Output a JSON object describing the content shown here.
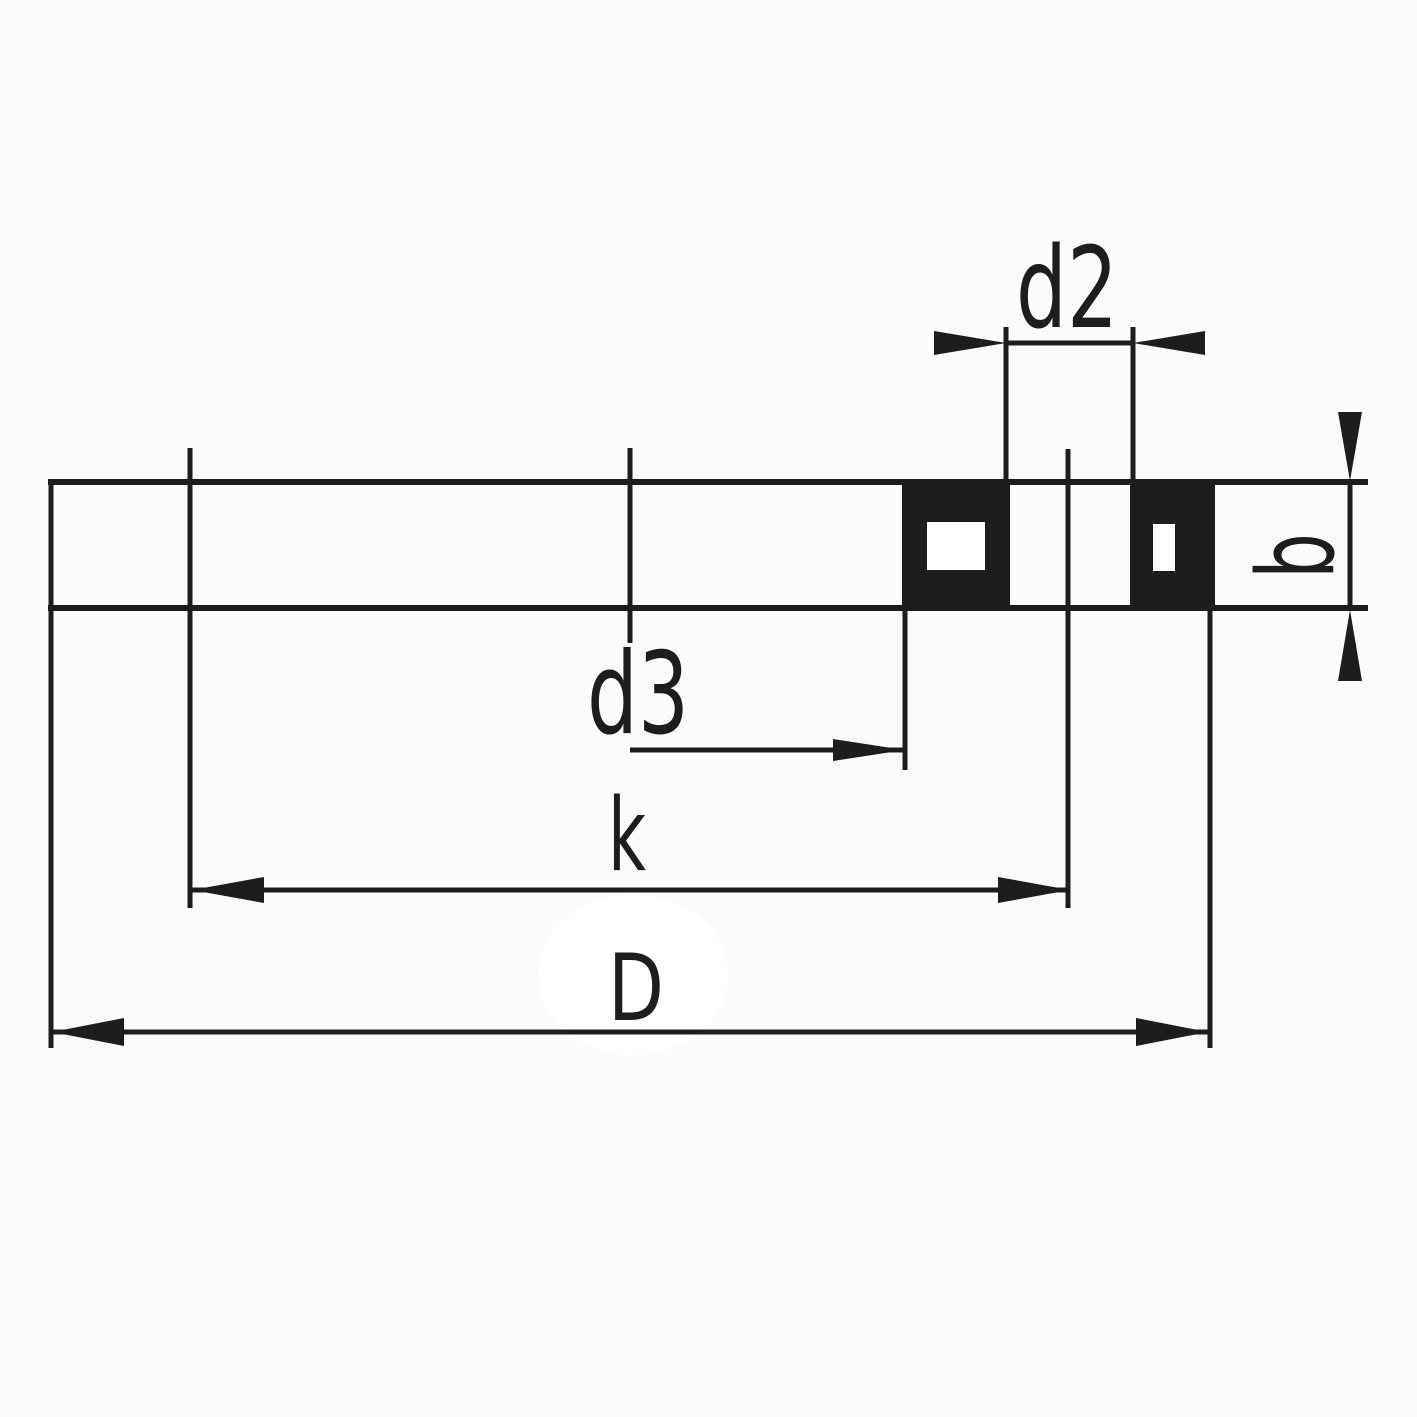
{
  "labels": {
    "d2": "d2",
    "d3": "d3",
    "k": "k",
    "D": "D",
    "b": "b"
  },
  "colors": {
    "line": "#1d1d1b",
    "section_fill": "#1d1d1b",
    "hole_fill": "#ffffff",
    "background": "#fbfbfb",
    "highlight": "#ffffff"
  }
}
